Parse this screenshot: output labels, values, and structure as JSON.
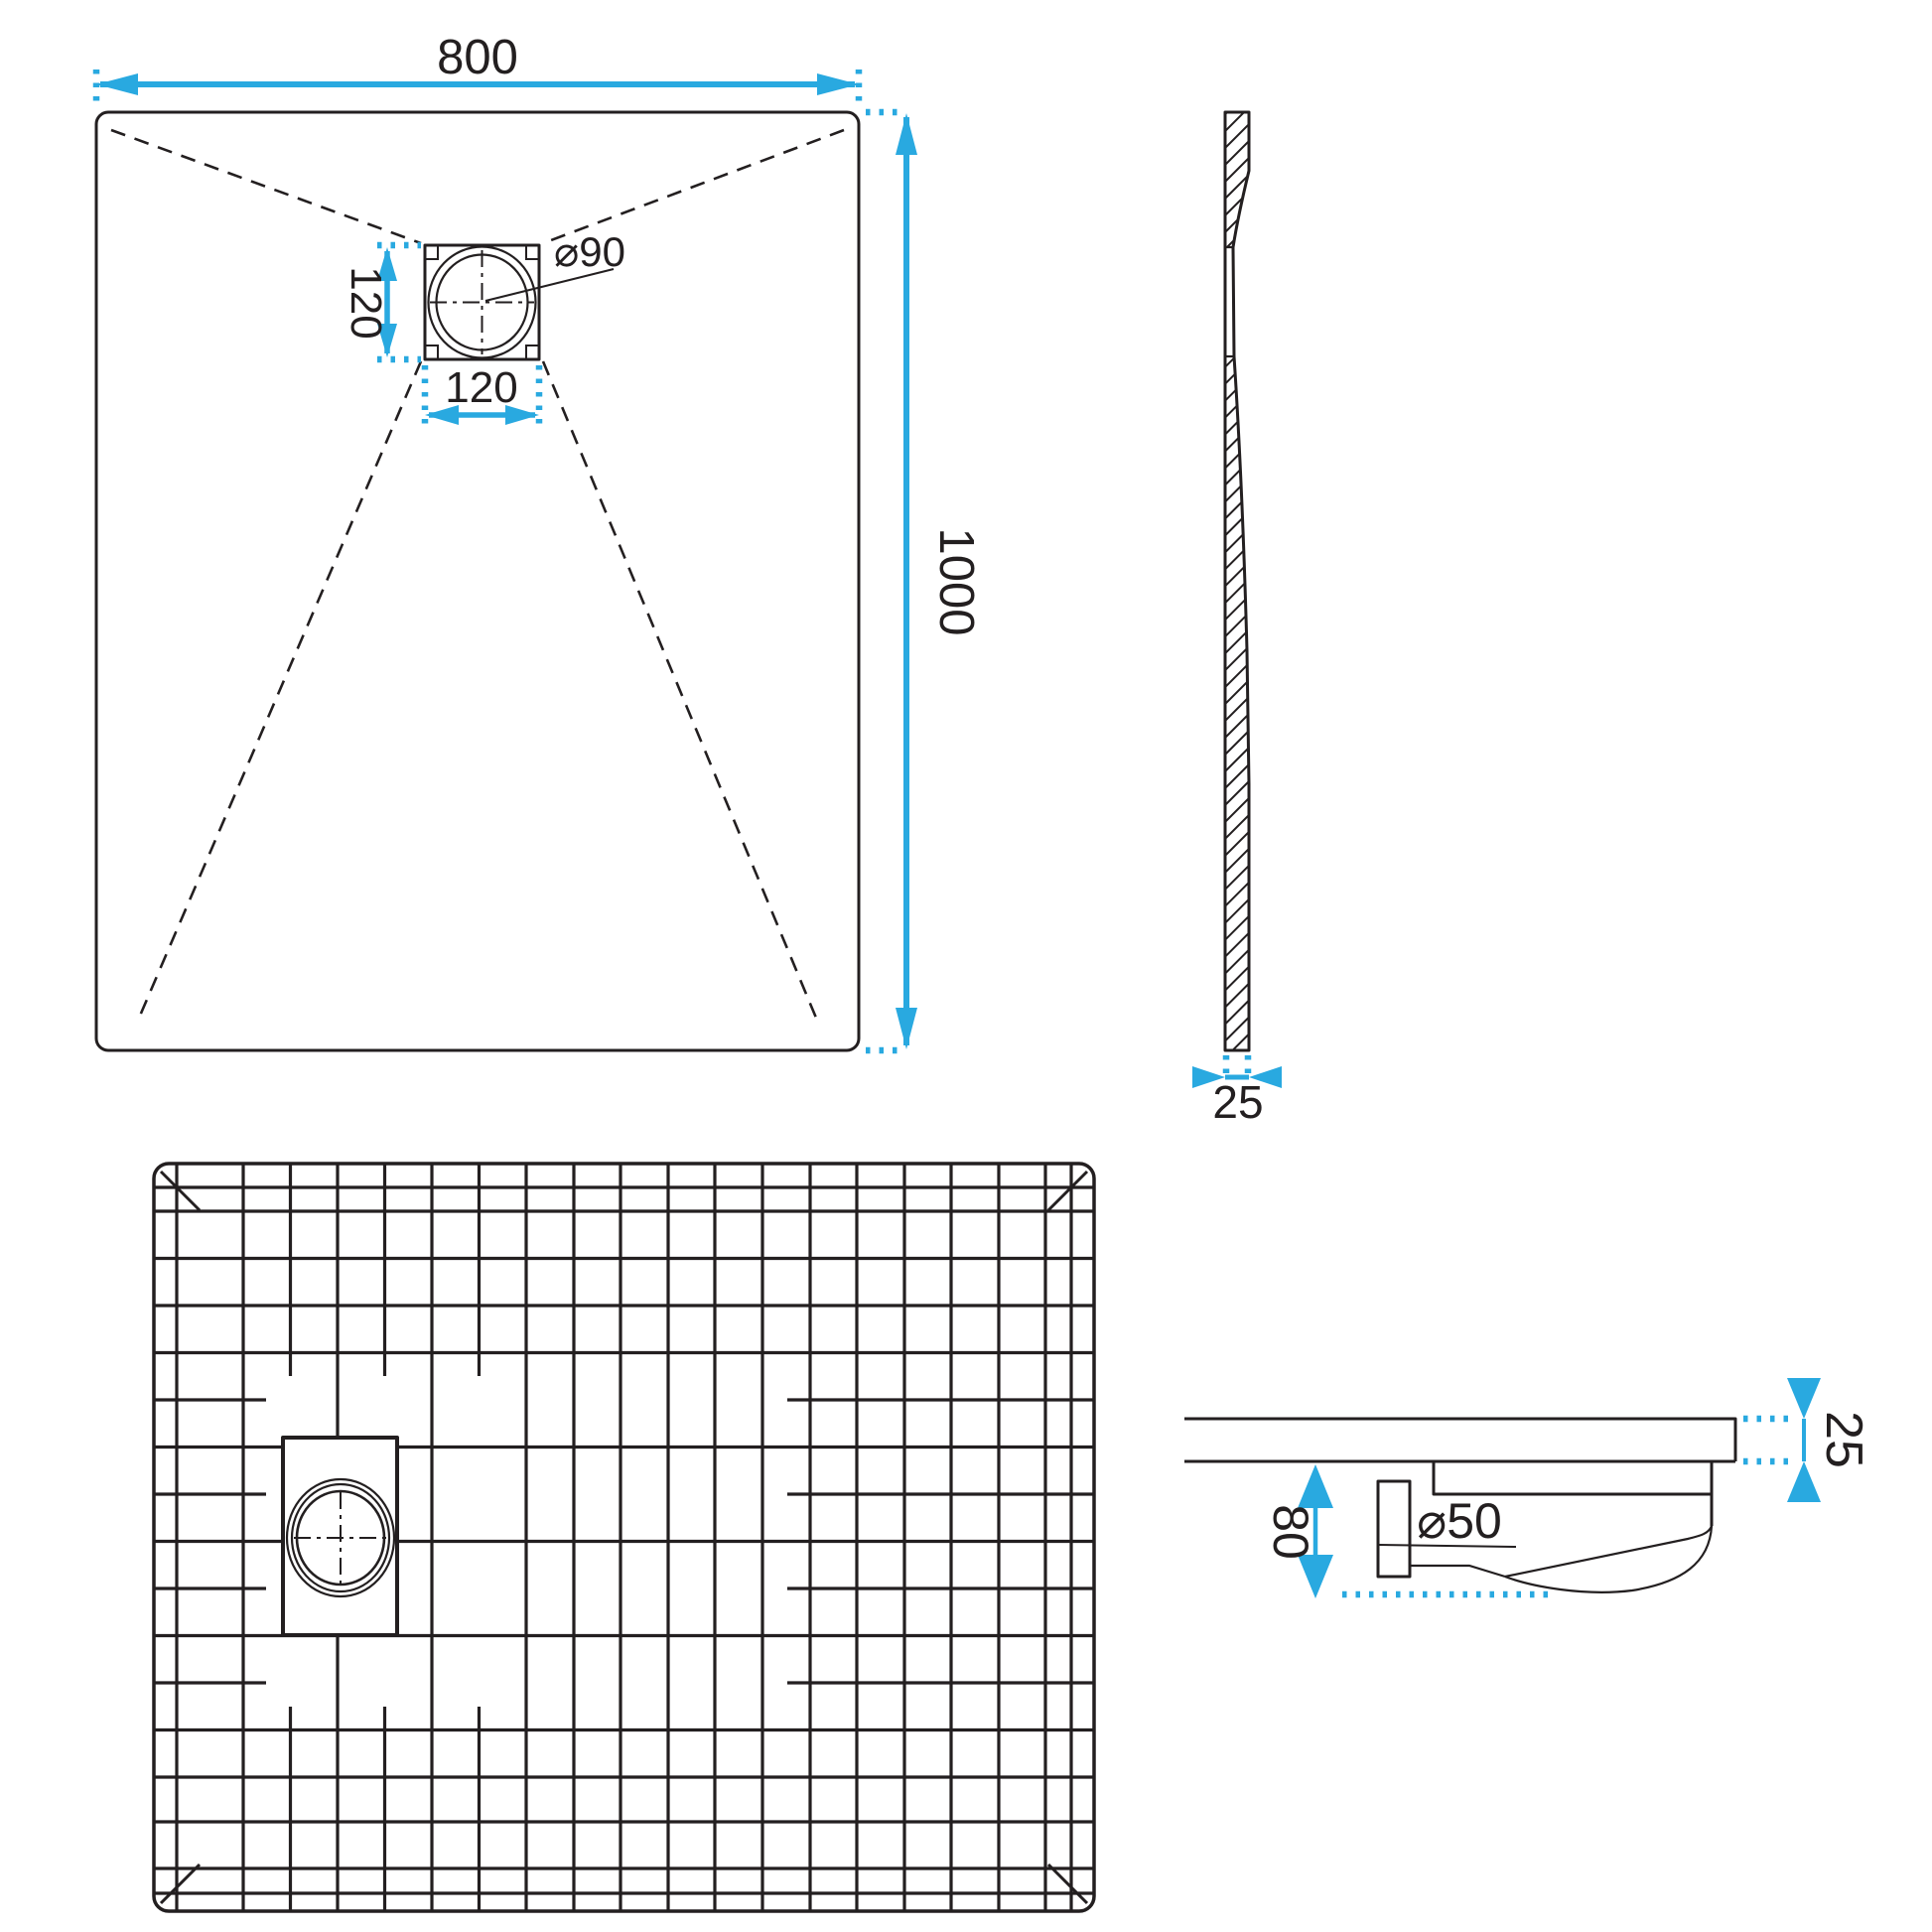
{
  "colors": {
    "accent": "#29A9E0",
    "line": "#231F20"
  },
  "labels": {
    "top_width": "800",
    "top_height": "1000",
    "drain_height": "120",
    "drain_width": "120",
    "drain_diameter": "⌀90",
    "side_thickness": "25",
    "detail_trap_height": "80",
    "detail_pipe_diameter": "⌀50",
    "detail_thickness": "25"
  }
}
